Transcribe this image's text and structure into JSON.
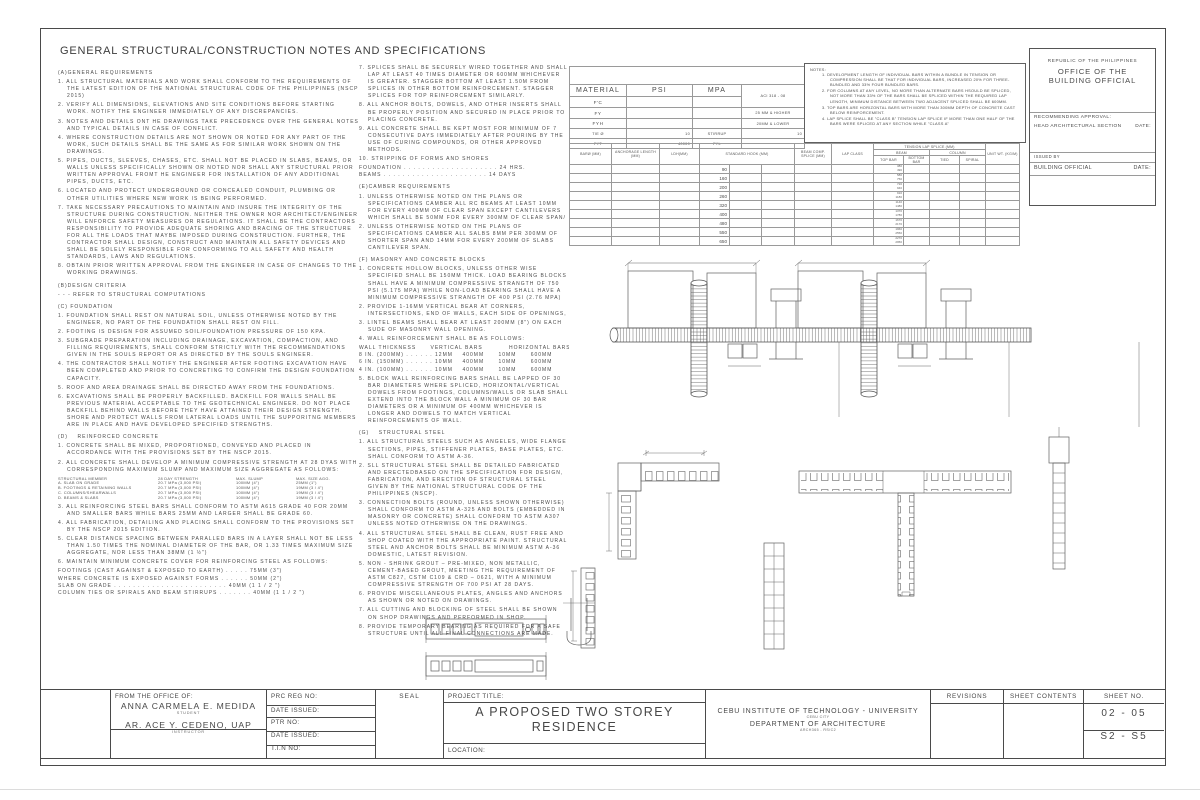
{
  "title": "GENERAL STRUCTURAL/CONSTRUCTION NOTES AND SPECIFICATIONS",
  "left": {
    "secA": {
      "heading": "(A)GENERAL REQUIREMENTS",
      "items": [
        "1.  ALL STRUCTURAL MATERIALS AND WORK SHALL CONFORM TO THE REQUIREMENTS OF THE LATEST EDITION OF THE NATIONAL STRUCTURAL CODE OF THE PHILIPPINES (NSCP 2015)",
        "2. VERIFY ALL DIMENSIONS, ELEVATIONS AND SITE CONDITIONS BEFORE STARTING WORK. NOTIFY THE ENGINEER IMMEDIATELY OF ANY DISCREPANCIES.",
        "3. NOTES AND DETAILS ONT HE DRAWINGS TAKE PRECEDENCE OVER THE GENERAL NOTES AND TYPICAL DETAILS IN CASE OF CONFLICT.",
        "4. WHERE CONSTRUCTION DETAILS ARE NOT SHOWN OR NOTED FOR ANY PART OF THE WORK, SUCH DETAILS SHALL BE THE SAME AS FOR SIMILAR WORK SHOWN ON THE DRAWINGS.",
        "5. PIPES, DUCTS, SLEEVES, CHASES, ETC. SHALL NOT BE PLACED IN SLABS, BEAMS, OR WALLS UNLESS SPECIFICALLY SHOWN OR NOTED NOR SHALL ANY STRUCTURAL PRIOR WRITTEN APPROVAL FROMT HE ENGINEER FOR INSTALLATION OF ANY ADDITIONAL PIPES, DUCTS, ETC.",
        "6. LOCATED AND PROTECT UNDERGROUND OR CONCEALED CONDUIT, PLUMBING OR OTHER UTILITIES WHERE NEW WORK IS BEING PERFORMED.",
        "7. TAKE NECESSARY PRECAUTIONS TO MAINTAIN AND INSURE THE INTEGRITY OF THE STRUCTURE DURING CONSTRUCTION. NEITHER THE OWNER NOR ARCHITECT/ENGINEER WILL ENFORCE SAFETY MEASURES OR REGULATIONS. IT SHALL BE THE CONTRACTORS RESPONSIBILITY TO PROVIDE ADEQUATE SHORING AND BRACING OF THE STRUCTURE FOR ALL THE LOADS THAT MAYBE IMPOSED DURING CONSTRUCTION. FURTHER, THE CONTRACTOR SHALL DESIGN, CONSTRUCT AND MAINTAIN ALL SAFETY DEVICES AND SHALL BE SOLELY RESPONSIBLE FOR CONFORMING TO ALL SAFETY AND HEALTH STANDARDS, LAWS AND REGULATIONS.",
        "8. OBTAIN PRIOR WRITTEN APPROVAL FROM THE ENGINEER IN CASE OF CHANGES TO THE WORKING DRAWINGS."
      ]
    },
    "secB": {
      "heading": "(B)DESIGN CRITERIA",
      "line": "- - - REFER TO STRUCTURAL COMPUTATIONS"
    },
    "secC": {
      "heading": "(C) FOUNDATION",
      "items": [
        "1. FOUNDATION SHALL REST ON NATURAL SOIL, UNLESS OTHERWISE NOTED BY THE ENGINEER, NO PART OF THE FOUNDATION SHALL REST ON FILL.",
        "2. FOOTING IS DESIGN FOR ASSUMED SOIL/FOUNDATION PRESSURE OF 150 KPA.",
        "3. SUBGRADE PREPARATION INCLUDING DRAINAGE, EXCAVATION, COMPACTION, AND FILLING REQUIREMENTS, SHALL CONFORM STRICTLY WITH THE RECOMMENDATIONS GIVEN IN THE SOULS REPORT OR AS DIRECTED BY THE SOULS ENGINEER.",
        "4. THE CONTRACTOR SHALL NOTIFY THE ENGINEER AFTER FOOTING EXCAVATION HAVE BEEN COMPLETED AND PRIOR TO CONCRETING TO CONFIRM THE DESIGN FOUNDATION CAPACITY.",
        "5. ROOF AND AREA DRAINAGE SHALL BE DIRECTED AWAY FROM THE FOUNDATIONS.",
        "6. EXCAVATIONS SHALL BE PROPERLY BACKFILLED. BACKFILL FOR WALLS SHALL BE PREVIOUS MATERIAL ACCEPTABLE TO THE GEOTECHNICAL ENGINEER. DO NOT PLACE BACKFILL BEHIND WALLS BEFORE THEY HAVE ATTAINED THEIR DESIGN STRENGTH. SHORE AND PROTECT WALLS FROM LATERAL LOADS UNTIL THE SUPPORITNG MEMBERS ARE IN PLACE AND HAVE DEVELOPED SPECIFIED STRENGTHS."
      ]
    },
    "secD": {
      "heading": "(D)    REINFORCED CONCRETE",
      "items_before": [
        "1. CONCRETE SHALL BE MIXED, PROPORTIONED, CONVEYED AND PLACED IN ACCORDANCE WITH THE PROVISIONS SET BY THE NSCP 2015.",
        "2.  ALL CONCRETE SHALL DEVELOP A MINIMUM COMPRESSIVE STRENGTH AT 28 DYAS WITH CORRESPONDING MAXIMUM SLUMP AND MAXIMUM SIZE AGGREGATE AS FOLLOWS:"
      ],
      "member_table": {
        "headers": [
          "STRUCTURAL MEMBER",
          "28 DAY STRENGTH",
          "MAX. SLUMP",
          "MAX. SIZE AGG."
        ],
        "rows": [
          [
            "A. SLAB ON GRADE",
            "20.7 MPa (3,000 PSI)",
            "100MM (4\")",
            "25MM (1\")"
          ],
          [
            "B. FOOTINGS & RETAINING WALLS",
            "20.7 MPa (3,000 PSI)",
            "100MM (4\")",
            "19MM (3 / 4\")"
          ],
          [
            "C. COLUMNS/SHEARWALLS",
            "20.7 MPa (3,000 PSI)",
            "100MM (4\")",
            "19MM (3 / 4\")"
          ],
          [
            "D. BEAMS & SLABS",
            "20.7 MPa (3,000 PSI)",
            "100MM (4\")",
            "19MM (3 / 4\")"
          ]
        ]
      },
      "items_after": [
        "3. ALL REINFORCING STEEL BARS SHALL CONFORM TO ASTM A615 GRADE 40 FOR 20MM    AND SMALLER BARS WHILE BARS 25MM    AND  LARGER SHALL BE GRADE 60.",
        "4. ALL FABRICATION, DETAILING AND PLACING SHALL CONFORM TO THE PROVISIONS SET BY  THE NSCP 2015 EDITION.",
        "5. CLEAR DISTANCE SPACING BETWEEN PARALLED BARS IN A LAYER SHALL NOT BE LESS THAN 1.50 TIMES THE NOMINAL DIAMETER OF THE BAR, OR 1.33 TIMES MAXIMUM SIZE AGGREGATE, NOR LESS THAN 38MM (1 ½\")",
        "6. MAINTAIN MINIMUM CONCRETE COVER FOR REINFORCING STEEL AS FOLLOWS:"
      ],
      "cover_lines": [
        "FOOTINGS (CAST AGAINST & EXPOSED TO EARTH) . . . . . 75MM (3\")",
        "WHERE CONCRETE IS EXPOSED AGAINST FORMS . . . . . . 50MM (2\")",
        "SLAB ON GRADE . . . . . . . . . . . . . . . . . . . . . . . . 40MM (1 1 / 2 \")",
        "COLUMN TIES OR SPIRALS AND BEAM STIRRUPS . . . . . . . 40MM (1 1 / 2 \")"
      ]
    }
  },
  "mid": {
    "items_7to10": [
      "7. SPLICES SHALL BE SECURELY WIRED TOGETHER AND SHALL LAP AT LEAST 40 TIMES DIAMETER OR 600MM WHICHEVER IS GREATER. STAGGER BOTTOM  AT LEAST 1.50M FROM SPLICES IN OTHER BOTTOM REINFORCEMENT. STAGGER SPLICES FOR TOP REINFORCEMENT SIMILARLY.",
      "8. ALL ANCHOR BOLTS, DOWELS, AND OTHER INSERTS SHALL BE PROPERLY POSITION AND SECURED IN PLACE PRIOR TO PLACING CONCRETE.",
      "9. ALL CONCRETE SHALL BE KEPT MOST FOR MINIMUM OF 7 CONSECUTIVE DAYS IMMEDIATELY AFTER POURING BY THE USE OF CURING COMPOUNDS, OR OTHER APPROVED METHODS.",
      "10. STRIPPING OF FORMS AND SHORES"
    ],
    "stripping_lines": [
      "FOUNDATION . . . . . . . . . . . . . . . . . . . . 24 HRS.",
      "BEAMS . . . . . . . . . . . . . . . . . . . . . . 14 DAYS"
    ],
    "secE": {
      "heading": "(E)CAMBER REQUIREMENTS",
      "items": [
        "1.  UNLESS OTHERWISE NOTED ON THE PLANS OR SPECIFICATIONS CAMBER ALL RC BEAMS AT LEAST 10MM FOR EVERY 400MM OF CLEAR SPAN EXCEPT CANTILEVERS WHICH SHALL BE 50MM FOR EVERY 300MM OF CLEAR SPAN/",
        "2.  UNLESS OTHERWISE NOTED ON THE PLANS OF SPECIFICATIONS CAMBER ALL SALBS 8MM PER 300MM OF SHORTER SPAN AND 14MM FOR EVERY 200MM OF SLABS CANTILEVER SPAN."
      ]
    },
    "secF": {
      "heading": "(F) MASONRY AND CONCRETE BLOCKS",
      "items_1to3": [
        "1.  CONCRETE HOLLOW BLOCKS, UNLESS OTHER WISE SPECIFIED SHALL BE 150MM THICK. LOAD BEARING BLOCKS SHALL HAVE A MINIMUM COMPRESSIVE STRANGTH OF  750 PSI (5.175 MPA) WHILE NON-LOAD BEARING SHALL HAVE A MINIMUM COMPRESSIVE STRANGTH OF 400 PSI (2.76 MPA)",
        "2. PROVIDE 1-16MM    VERTICAL BEAR AT CORNERS, INTERSECTIONS, END OF WALLS, EACH SIDE OF OPENINGS,",
        "3. LINTEL BEAMS SHALL BEAR AT LEAST 200MM (8\") ON EACH SUDE OF MASONRY WALL OPENING."
      ],
      "item_4": "4. WALL REINFORCEMENT SHALL BE AS FOLLOWS:",
      "wall_table_lines": [
        "WALL THICKNESS      VERTICAL BARS           HORIZONTAL BARS",
        "8 IN. (200MM) . . . . . . 12MM    400MM      10MM      600MM",
        "6 IN. (150MM) . . . . . . 10MM    400MM      10MM      600MM",
        "4 IN. (100MM) . . . . . . 10MM    400MM      10MM      600MM"
      ],
      "item_5": "5. BLOCK WALL REINFORCING BARS SHALL BE LAPPED OF 30 BAR DIAMETERS WHERE SPLICED, HORIZONTAL/VERTICAL DOWELS FROM FOOTINGS, COLUMNS/WALLS OR SLAB SHALL EXTEND INTO THE BLOCK WALL A MINIMUM OF 30 BAR DIAMETERS OR A MINIMUM OF 400MM WHICHEVER IS LONGER AND DOWELS TO MATCH VERTICAL REINFORCEMENTS OF WALL."
    },
    "secG": {
      "heading": "(G)    STRUCTURAL STEEL",
      "items": [
        "1. ALL STRUCTURAL STEELS SUCH AS ANGELES, WIDE FLANGE SECTIONS, PIPES, STIFFENER PLATES, BASE PLATES, ETC. SHALL CONFORM TO ASTM A-36.",
        "2. SLL STRUCTURAL STEEL SHALL BE DETAILED FABRICATED AND ERECTEDBASED ON THE SPECIFICATION FOR DESIGN, FABRICATION, AND ERECTION OF STRUCTURAL STEEL GIVEN BY THE NATIONAL STRUCTURAL CODE OF THE PHILIPPINES (NSCP).",
        "3. CONNECTION BOLTS (ROUND, UNLESS SHOWN OTHERWISE) SHALL CONFORM TO ASTM A-325 AND BOLTS (EMBEDDED IN MASONRY OR CONCRETE) SHALL CONFORM TO ASTM A307 UNLESS NOTED OTHERWISE ON THE DRAWINGS.",
        "4. ALL STRUCTURAL STEEL SHALL BE CLEAN, RUST FREE AND SHOP COATED WITH THE APPROPRIATE PAINT. STRUCTURAL STEEL AND ANCHOR BOLTS SHALL BE MINIMUM ASTM A-36 DOMESTIC, LATEST REVISION.",
        "5. NON - SHRINK GROUT – PRE-MIXED, NON METALLIC, CEMENT-BASED GROUT, MEETING THE REQUIREMENT OF ASTM C827, CSTM C109 & CRD – 0621, WITH  A MINIMUM COMPRESSIVE STRENGTH OF  700 PSI AT 28 DAYS.",
        "6. PROVIDE MISCELLANEOUS PLATES, ANGLES AND ANCHORS AS SHOWN OR NOTED ON DRAWINGS.",
        "7. ALL CUTTING AND BLOCKING OF STEEL SHALL BE SHOWN ON SHOP DRAWINGS AND PERFORMED IN SHOP.",
        "8. PROVIDE TEMPORARY BEARING AS REQUIRED FOR A SAFE STRUCTURE UNTIL ALL FINAL CONNECTIONS ARE MADE."
      ]
    }
  },
  "material_table": {
    "header": [
      "MATERIAL",
      "PSI",
      "MPA"
    ],
    "rows": [
      {
        "name": "F'C",
        "psi": "",
        "mpa": "",
        "side": "ACI 318 - 08"
      },
      {
        "name": "FY",
        "psi": "",
        "mpa": "",
        "side": "25 MM & HIGHER"
      },
      {
        "name": "FYH",
        "psi": "",
        "mpa": "",
        "side": "20MM & LOWER"
      }
    ],
    "tie_row": {
      "c1": "TIE Ø",
      "v1": "10",
      "c2": "STIRRUP",
      "v2": "10"
    },
    "fyt_row": {
      "c1": "FYT",
      "v1": "40000",
      "c2": "FYL",
      "v2": ""
    }
  },
  "bar_table": {
    "headers": {
      "baro": "BARØ (MM)",
      "anchorage": "ANCHORAGE LENGTH (MM)",
      "ldh": "LDH(MM)",
      "hook": "STANDARD HOOK (MM)",
      "beam_comp": "BEAM COMP. SPLICE (MM)",
      "lap_class": "LAP CLASS",
      "tension": "TENSION LAP SPLICE (MM)",
      "beam": "BEAM",
      "column": "COLUMN",
      "top_bar": "TOP BAR",
      "bottom_bar": "BOTTOM BAR",
      "tied": "TIED",
      "spiral": "SPIRAL",
      "unit_wt": "UNIT WT. (KG/M)"
    },
    "rows": [
      {
        "hook": "90",
        "top": [
          "380",
          "490"
        ]
      },
      {
        "hook": "160",
        "top": [
          "580",
          "750"
        ]
      },
      {
        "hook": "200",
        "top": [
          "720",
          "940"
        ]
      },
      {
        "hook": "260",
        "top": [
          "910",
          "1180"
        ]
      },
      {
        "hook": "320",
        "top": [
          "1140",
          "1480"
        ]
      },
      {
        "hook": "400",
        "top": [
          "1370",
          "1780"
        ]
      },
      {
        "hook": "480",
        "top": [
          "1670",
          "2170"
        ]
      },
      {
        "hook": "550",
        "top": [
          "1960",
          "2550"
        ]
      },
      {
        "hook": "650",
        "top": [
          "2270",
          "2950"
        ]
      }
    ]
  },
  "notes_box": {
    "title": "NOTES:",
    "items": [
      "1.   DEVELOPMENT LENGTH OF INDIVIDUAL BARS WITHIN A BUNDLE IN TENSION OR COMPRESSION SHALL BE THAT FOR INDIVIDUAL BARS, INCREASED 20% FOR THREE-BUNDLED AND 33% FOUR BUNDLED BARS.",
      "2.   FOR COLUMNS AT ANY LEVEL, NO MORE THAN ALTERNATE BARS HSOULD BE SPLICED, NOT MORE THAN 33% OF THE BARS SHALL BE SPLICED WITHIN THE REQUIRED LAP LENGTH, MINIMUM DISTANCE BETWEEN TWO ADJACENT SPLICED SHALL BE 600MM.",
      "3.   TOP BARS ARE HORIZONTAL BARS WITH MORE THAN 300MM DEPTH OF CONCRETE CAST BELOW REINFORCEMENT.",
      "4.   LAP SPLICE SHALL BE \"CLASS B\" TENSION LAP SPLICE IF MORE THAN ONE HALF OF THE BARS WERE SPLICED AT ANY SECTION WHILE \"CLASS A\""
    ]
  },
  "official_box": {
    "republic": "REPUBLIC OF THE PHILIPPINES",
    "office": "OFFICE OF THE BUILDING OFFICIAL",
    "recommending": "RECOMMENDING APPROVAL:",
    "head_section": "HEAD ARCHITECTURAL SECTION",
    "date_label": "DATE:",
    "issued_by": "ISSUED BY",
    "building_official": "BUILDING OFFICIAL",
    "date_label2": "DATE:"
  },
  "title_block": {
    "from_office_label": "FROM THE OFFICE OF:",
    "student_name": "ANNA CARMELA E. MEDIDA",
    "student_role": "STUDENT",
    "instructor_name": "AR. ACE Y. CEDENO, UAP",
    "instructor_role": "INSTRUCTOR",
    "prc_label": "PRC REG NO:",
    "date_issued_label": "DATE ISSUED:",
    "ptr_label": "PTR NO:",
    "date_issued2_label": "DATE ISSUED:",
    "tin_label": "T.I.N NO:",
    "seal_label": "SEAL",
    "project_title_label": "PROJECT TITLE:",
    "project_title_line1": "A PROPOSED TWO STOREY",
    "project_title_line2": "RESIDENCE",
    "location_label": "LOCATION:",
    "institution": "CEBU  INSTITUTE OF TECHNOLOGY - UNIVERSITY",
    "institution_city": "CEBU CITY",
    "department": "DEPARTMENT OF ARCHITECTURE",
    "course_code": "ARCH365 - RS/C2",
    "revisions_label": "REVISIONS",
    "sheet_contents_label": "SHEET CONTENTS",
    "sheet_no_label": "SHEET NO.",
    "sheet_no_1": "02 - 05",
    "sheet_no_2": "S2 - S5"
  }
}
